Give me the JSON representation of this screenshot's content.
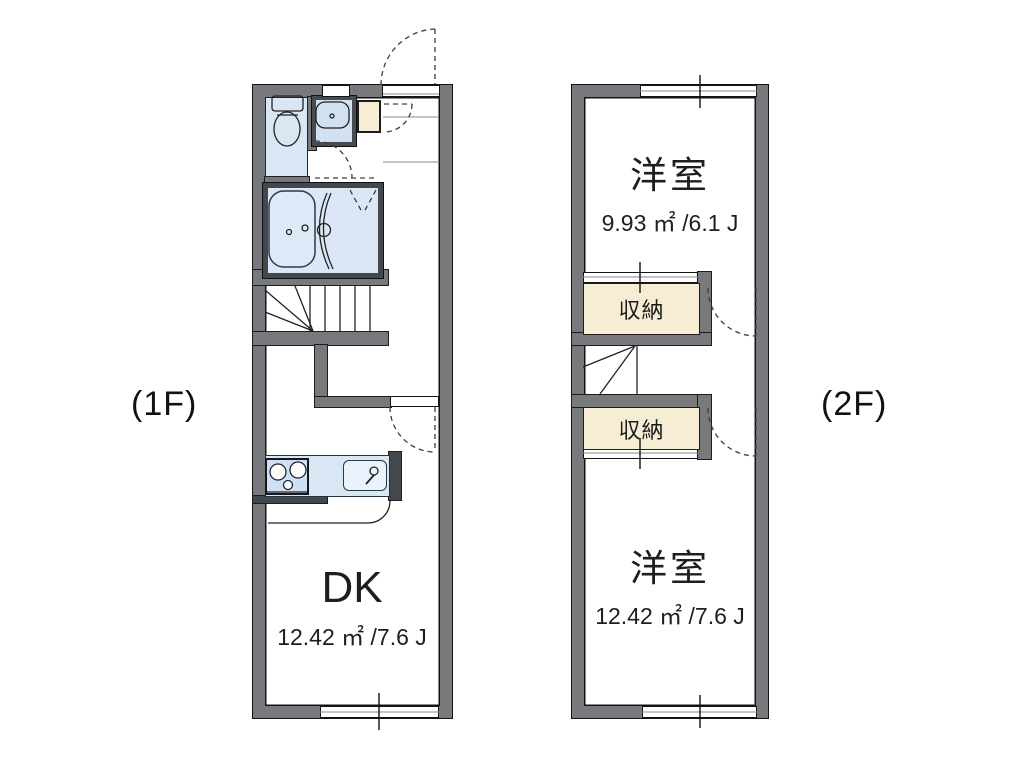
{
  "floors": [
    {
      "label": "(1F)",
      "dk": {
        "name": "DK",
        "area": "12.42 ㎡ /7.6 J"
      },
      "washer_label": "洗置"
    },
    {
      "label": "(2F)",
      "room_upper": {
        "name": "洋室",
        "area": "9.93 ㎡ /6.1 J"
      },
      "room_lower": {
        "name": "洋室",
        "area": "12.42 ㎡ /7.6 J"
      },
      "closet_upper": "収納",
      "closet_lower": "収納"
    }
  ],
  "colors": {
    "wall": "#77797c",
    "wall_dark": "#43484e",
    "fixture_blue": "#d9e6f4",
    "bath_blue": "#dbe7f6",
    "closet_cream": "#f7ecd4",
    "line": "#1c1c1c",
    "background": "#ffffff"
  }
}
